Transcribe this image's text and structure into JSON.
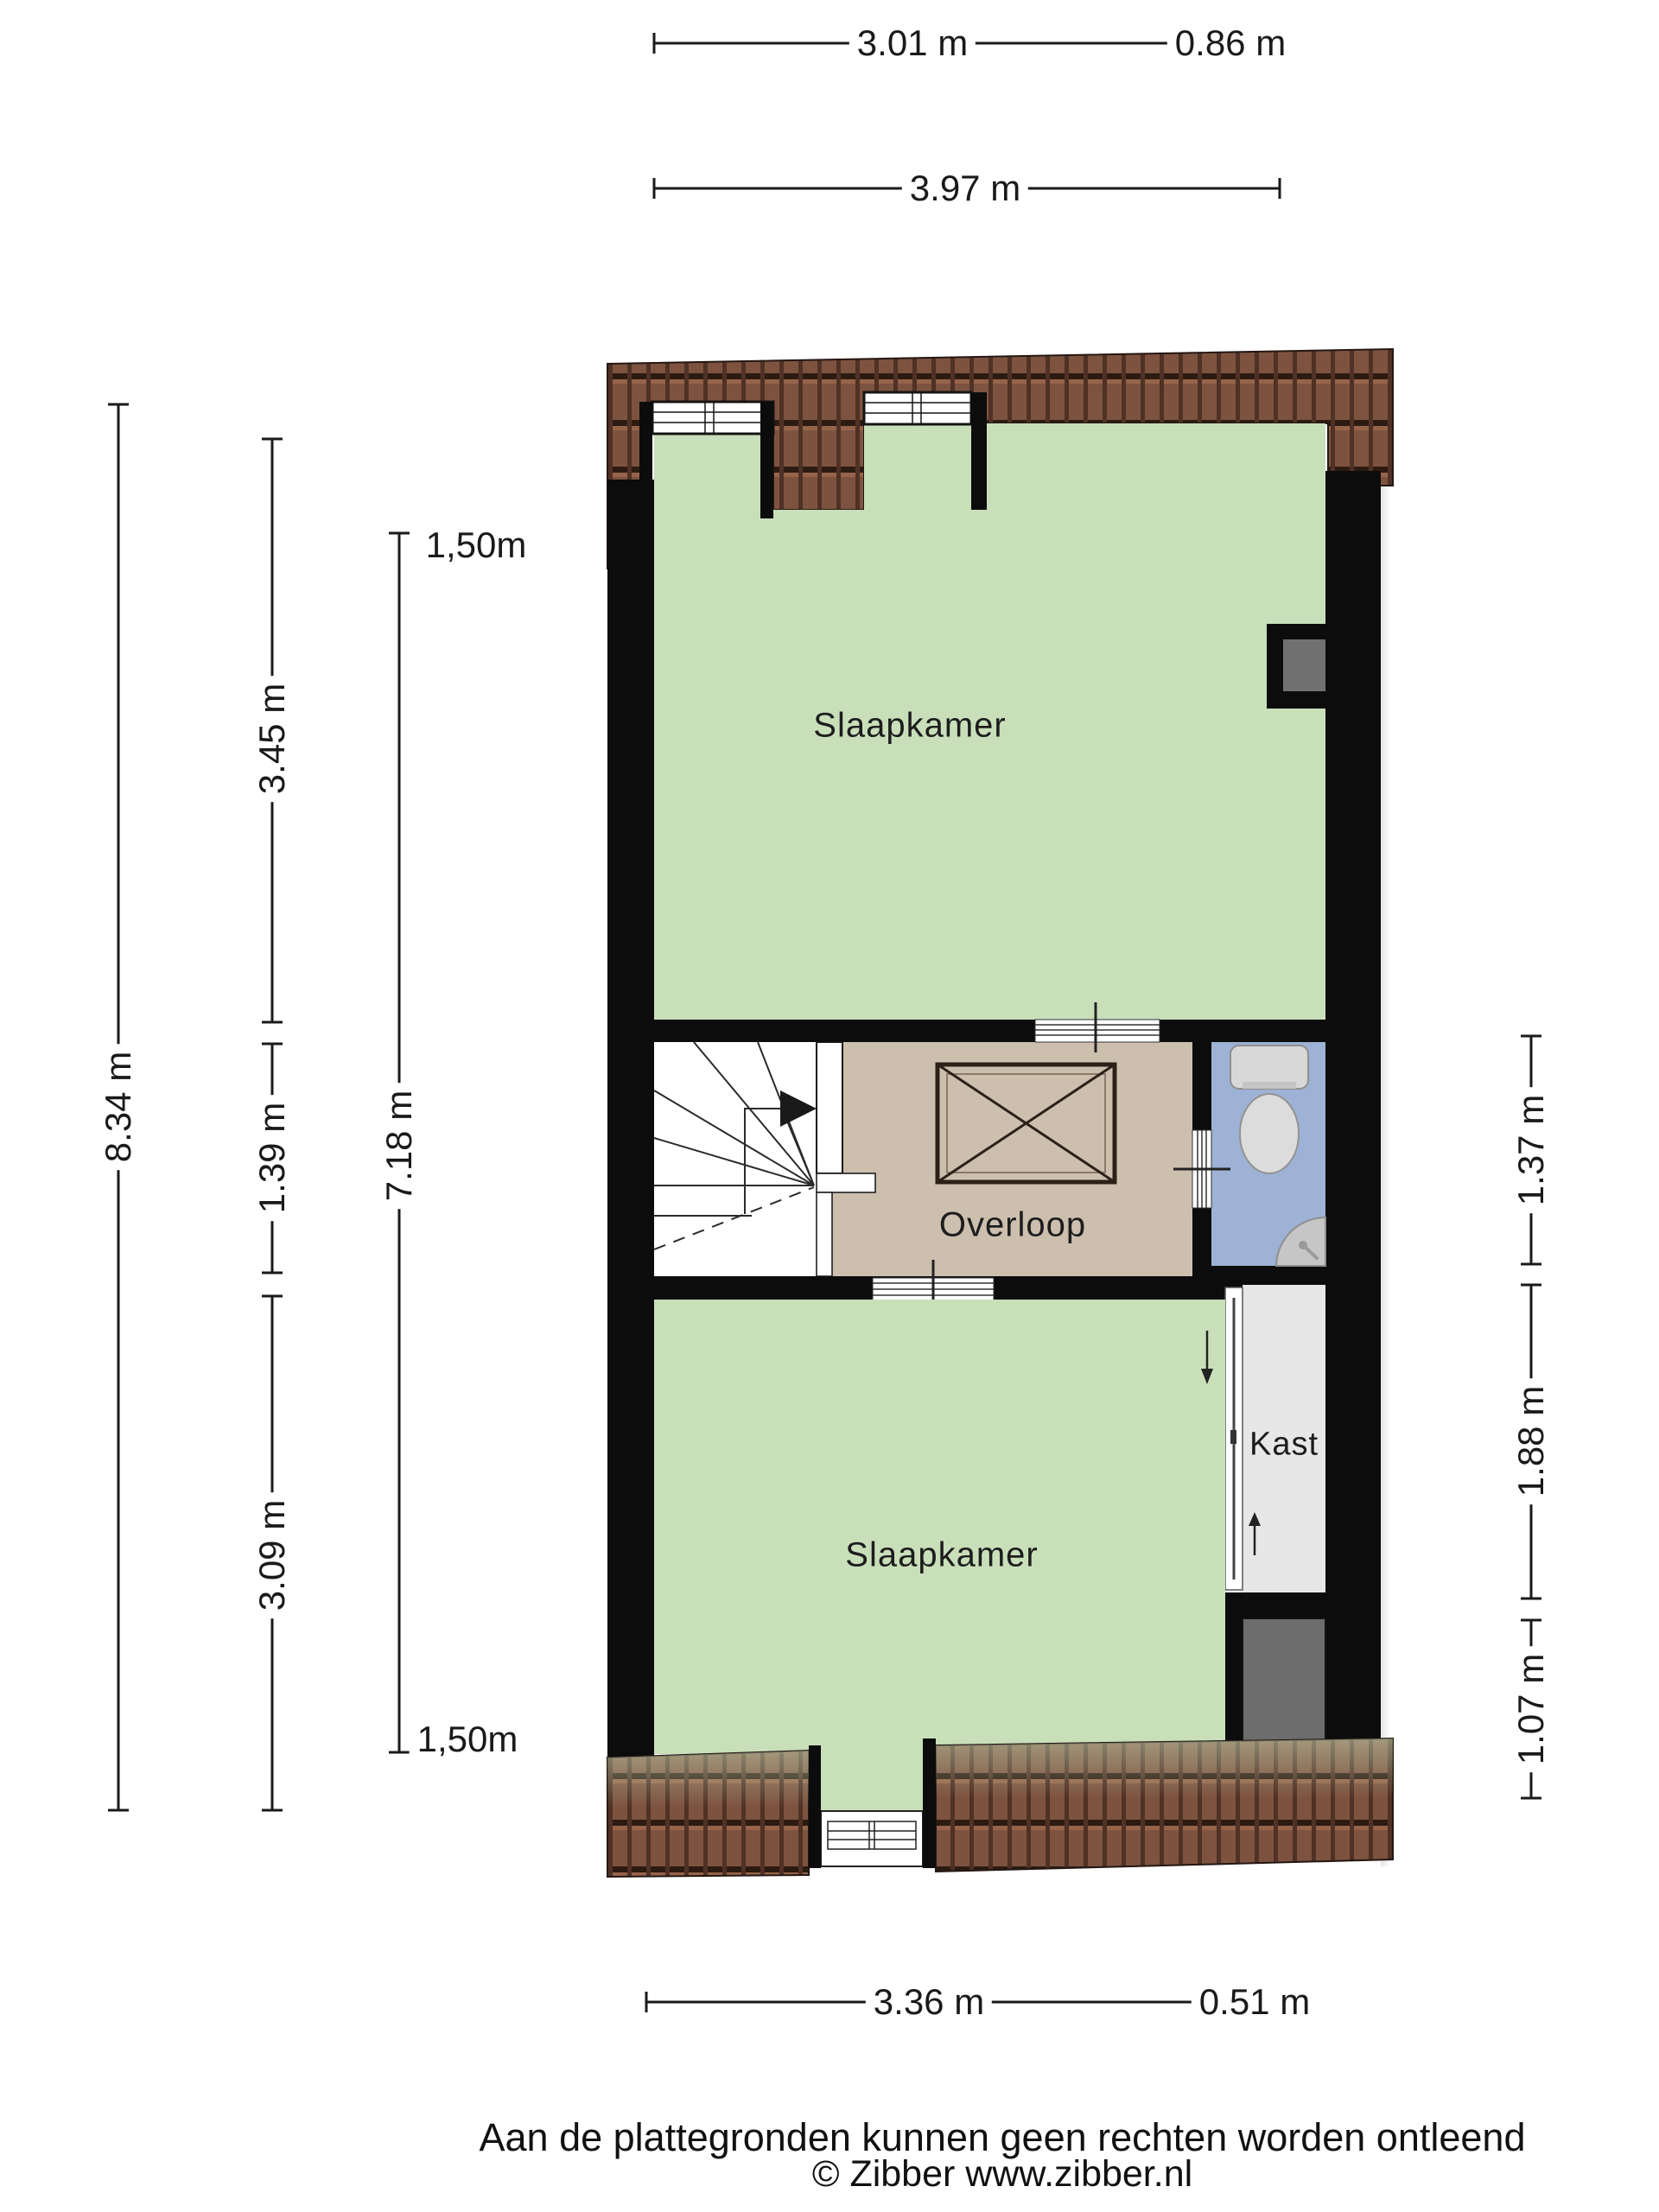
{
  "title": "Floor plan - second floor (Zibber plattegrond)",
  "rooms": {
    "bedroom_top": {
      "label": "Slaapkamer"
    },
    "landing": {
      "label": "Overloop"
    },
    "bedroom_bottom": {
      "label": "Slaapkamer"
    },
    "closet": {
      "label": "Kast"
    }
  },
  "dimensions": {
    "top": {
      "left_segment": "3.01 m",
      "right_segment": "0.86 m",
      "total": "3.97 m"
    },
    "left": {
      "overall": "8.34 m",
      "upper": "3.45 m",
      "middle": "1.39 m",
      "lower": "3.09 m",
      "inner_total": "7.18 m",
      "clearance_upper": "1,50m",
      "clearance_lower": "1,50m"
    },
    "right": {
      "upper": "1.37 m",
      "middle": "1.88 m",
      "lower": "1.07 m"
    },
    "bottom": {
      "left_segment": "3.36 m",
      "right_segment": "0.51 m"
    }
  },
  "footer": {
    "disclaimer": "Aan de plattegronden kunnen geen rechten worden ontleend",
    "credit": "© Zibber www.zibber.nl"
  },
  "icons": {
    "stairs": "stairs-icon",
    "void_box": "void-box-icon",
    "toilet": "toilet-icon",
    "corner_sink": "corner-sink-icon",
    "sliding_door": "sliding-door-icon",
    "arrow_down": "arrow-down-icon",
    "arrow_up": "arrow-up-icon"
  },
  "colors": {
    "wall": "#0c0c0c",
    "room_green": "#c9dfba",
    "landing_tan": "#cdbfae",
    "bathroom_blue": "#9db2d4",
    "closet_gray": "#e7e7e7",
    "shaft_gray": "#6d6d6d",
    "roof_brown": "#7d5340",
    "dimension_line": "#1a1a1a"
  }
}
